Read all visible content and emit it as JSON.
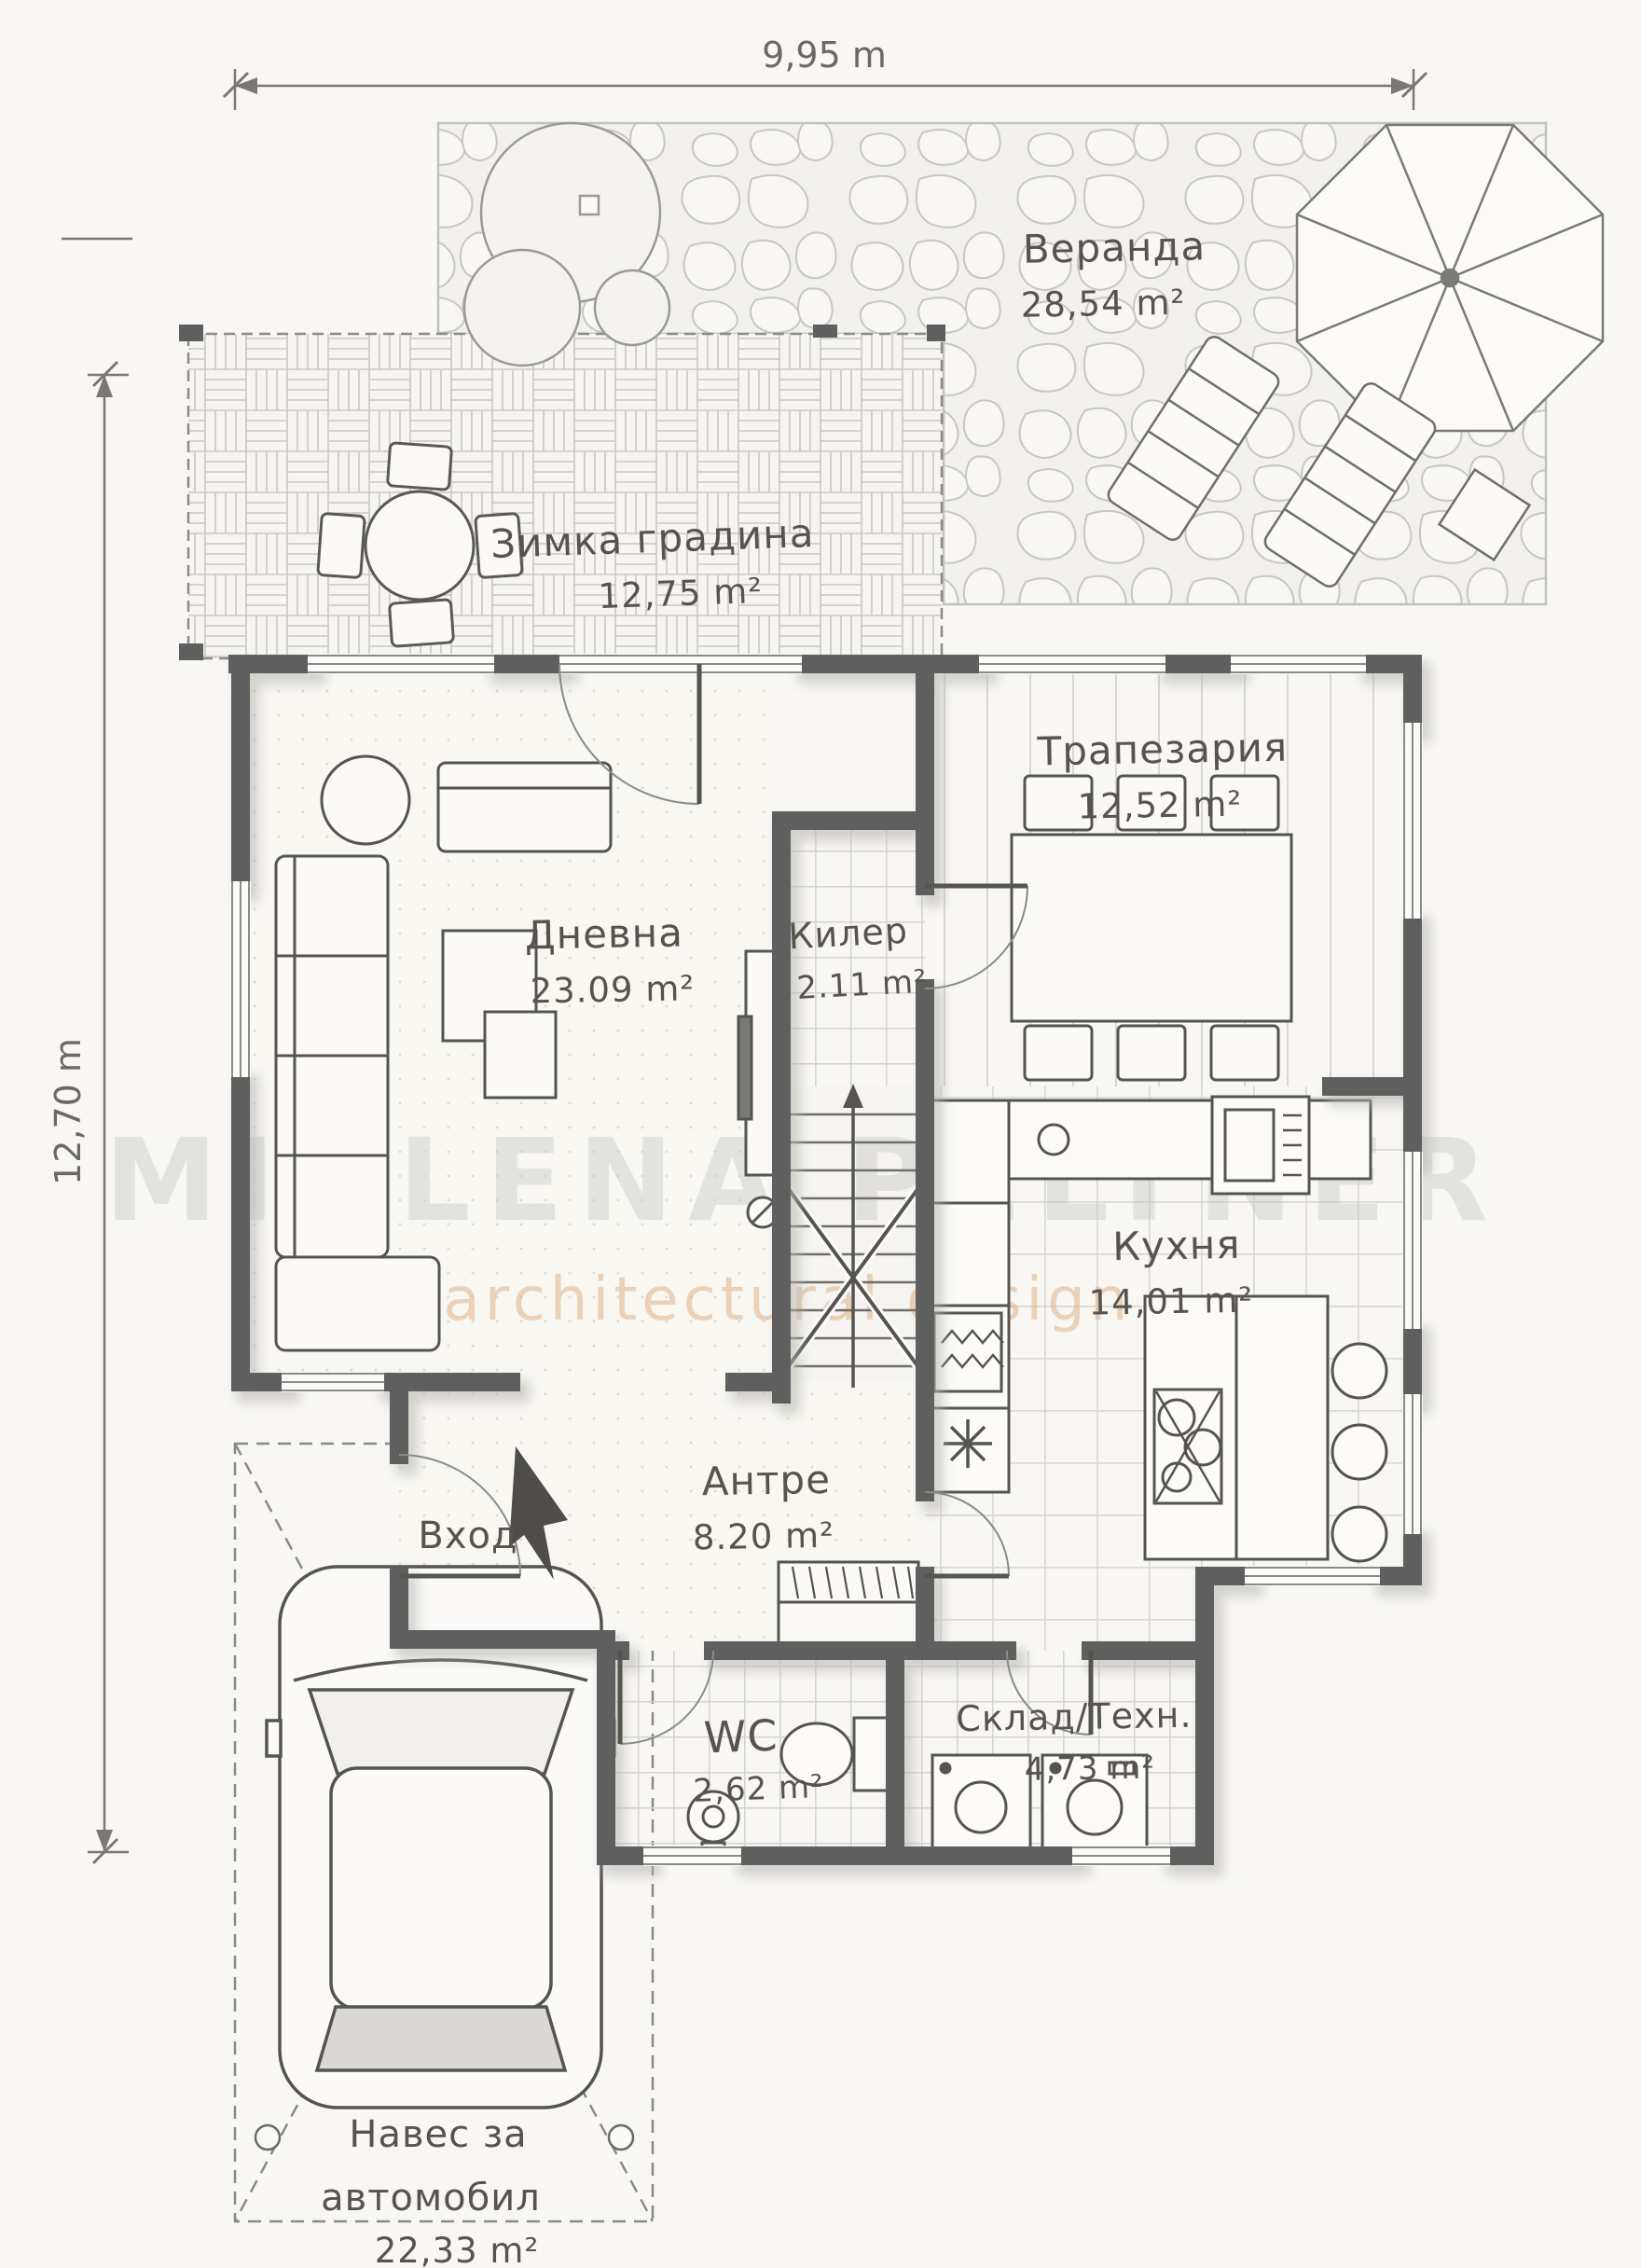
{
  "plan": {
    "dimensions": {
      "top": "9,95 m",
      "left": "12,70 m"
    },
    "entrance_label": "Вход",
    "watermark": {
      "line1": "MIGLENA PELTNER",
      "line2": "architectural design"
    },
    "rooms": {
      "veranda": {
        "name": "Веранда",
        "area": "28,54 m²"
      },
      "winter_garden": {
        "name": "Зимка градина",
        "area": "12,75 m²"
      },
      "dining": {
        "name": "Трапезария",
        "area": "12,52 m²"
      },
      "living": {
        "name": "Дневна",
        "area": "23.09 m²"
      },
      "pantry": {
        "name": "Килер",
        "area": "2.11 m²"
      },
      "kitchen": {
        "name": "Кухня",
        "area": "14,01 m²"
      },
      "hall": {
        "name": "Антре",
        "area": "8.20 m²"
      },
      "wc": {
        "name": "WC",
        "area": "2,62 m²"
      },
      "storage": {
        "name": "Склад/Техн.",
        "area": "4,73 m²"
      },
      "carport": {
        "line1": "Навес за",
        "line2": "автомобил",
        "area": "22,33 m²"
      }
    },
    "colors": {
      "wall": "#5f5f5f",
      "ink": "#57544f",
      "paper": "#f8f7f4",
      "watermark_gray": "#c9c9c9",
      "watermark_tan": "#ddad7e"
    }
  }
}
